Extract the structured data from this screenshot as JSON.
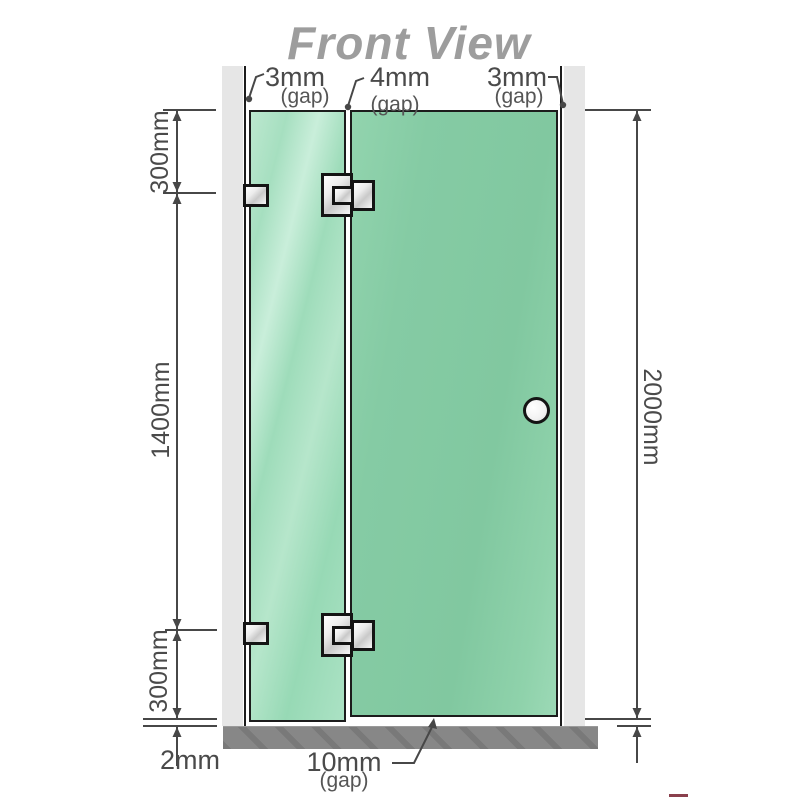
{
  "title": "Front View",
  "diagram": {
    "type": "shower-screen-front-elevation",
    "top_gap_labels": [
      {
        "value": "3mm",
        "qualifier": "(gap)"
      },
      {
        "value": "4mm",
        "qualifier": "(gap)"
      },
      {
        "value": "3mm",
        "qualifier": "(gap)"
      }
    ],
    "left_dimensions": {
      "top": "300mm",
      "middle": "1400mm",
      "bottom": "300mm"
    },
    "right_dimension": "2000mm",
    "bottom_floor_gap": "2mm",
    "bottom_door_gap": {
      "value": "10mm",
      "qualifier": "(gap)"
    },
    "colors": {
      "glass_fixed": "#a6dfc0",
      "glass_door": "#85cba4",
      "wall_channel": "#e6e6e6",
      "floor": "#878787",
      "linework": "#474747",
      "title_gray": "#9d9d9d"
    }
  }
}
